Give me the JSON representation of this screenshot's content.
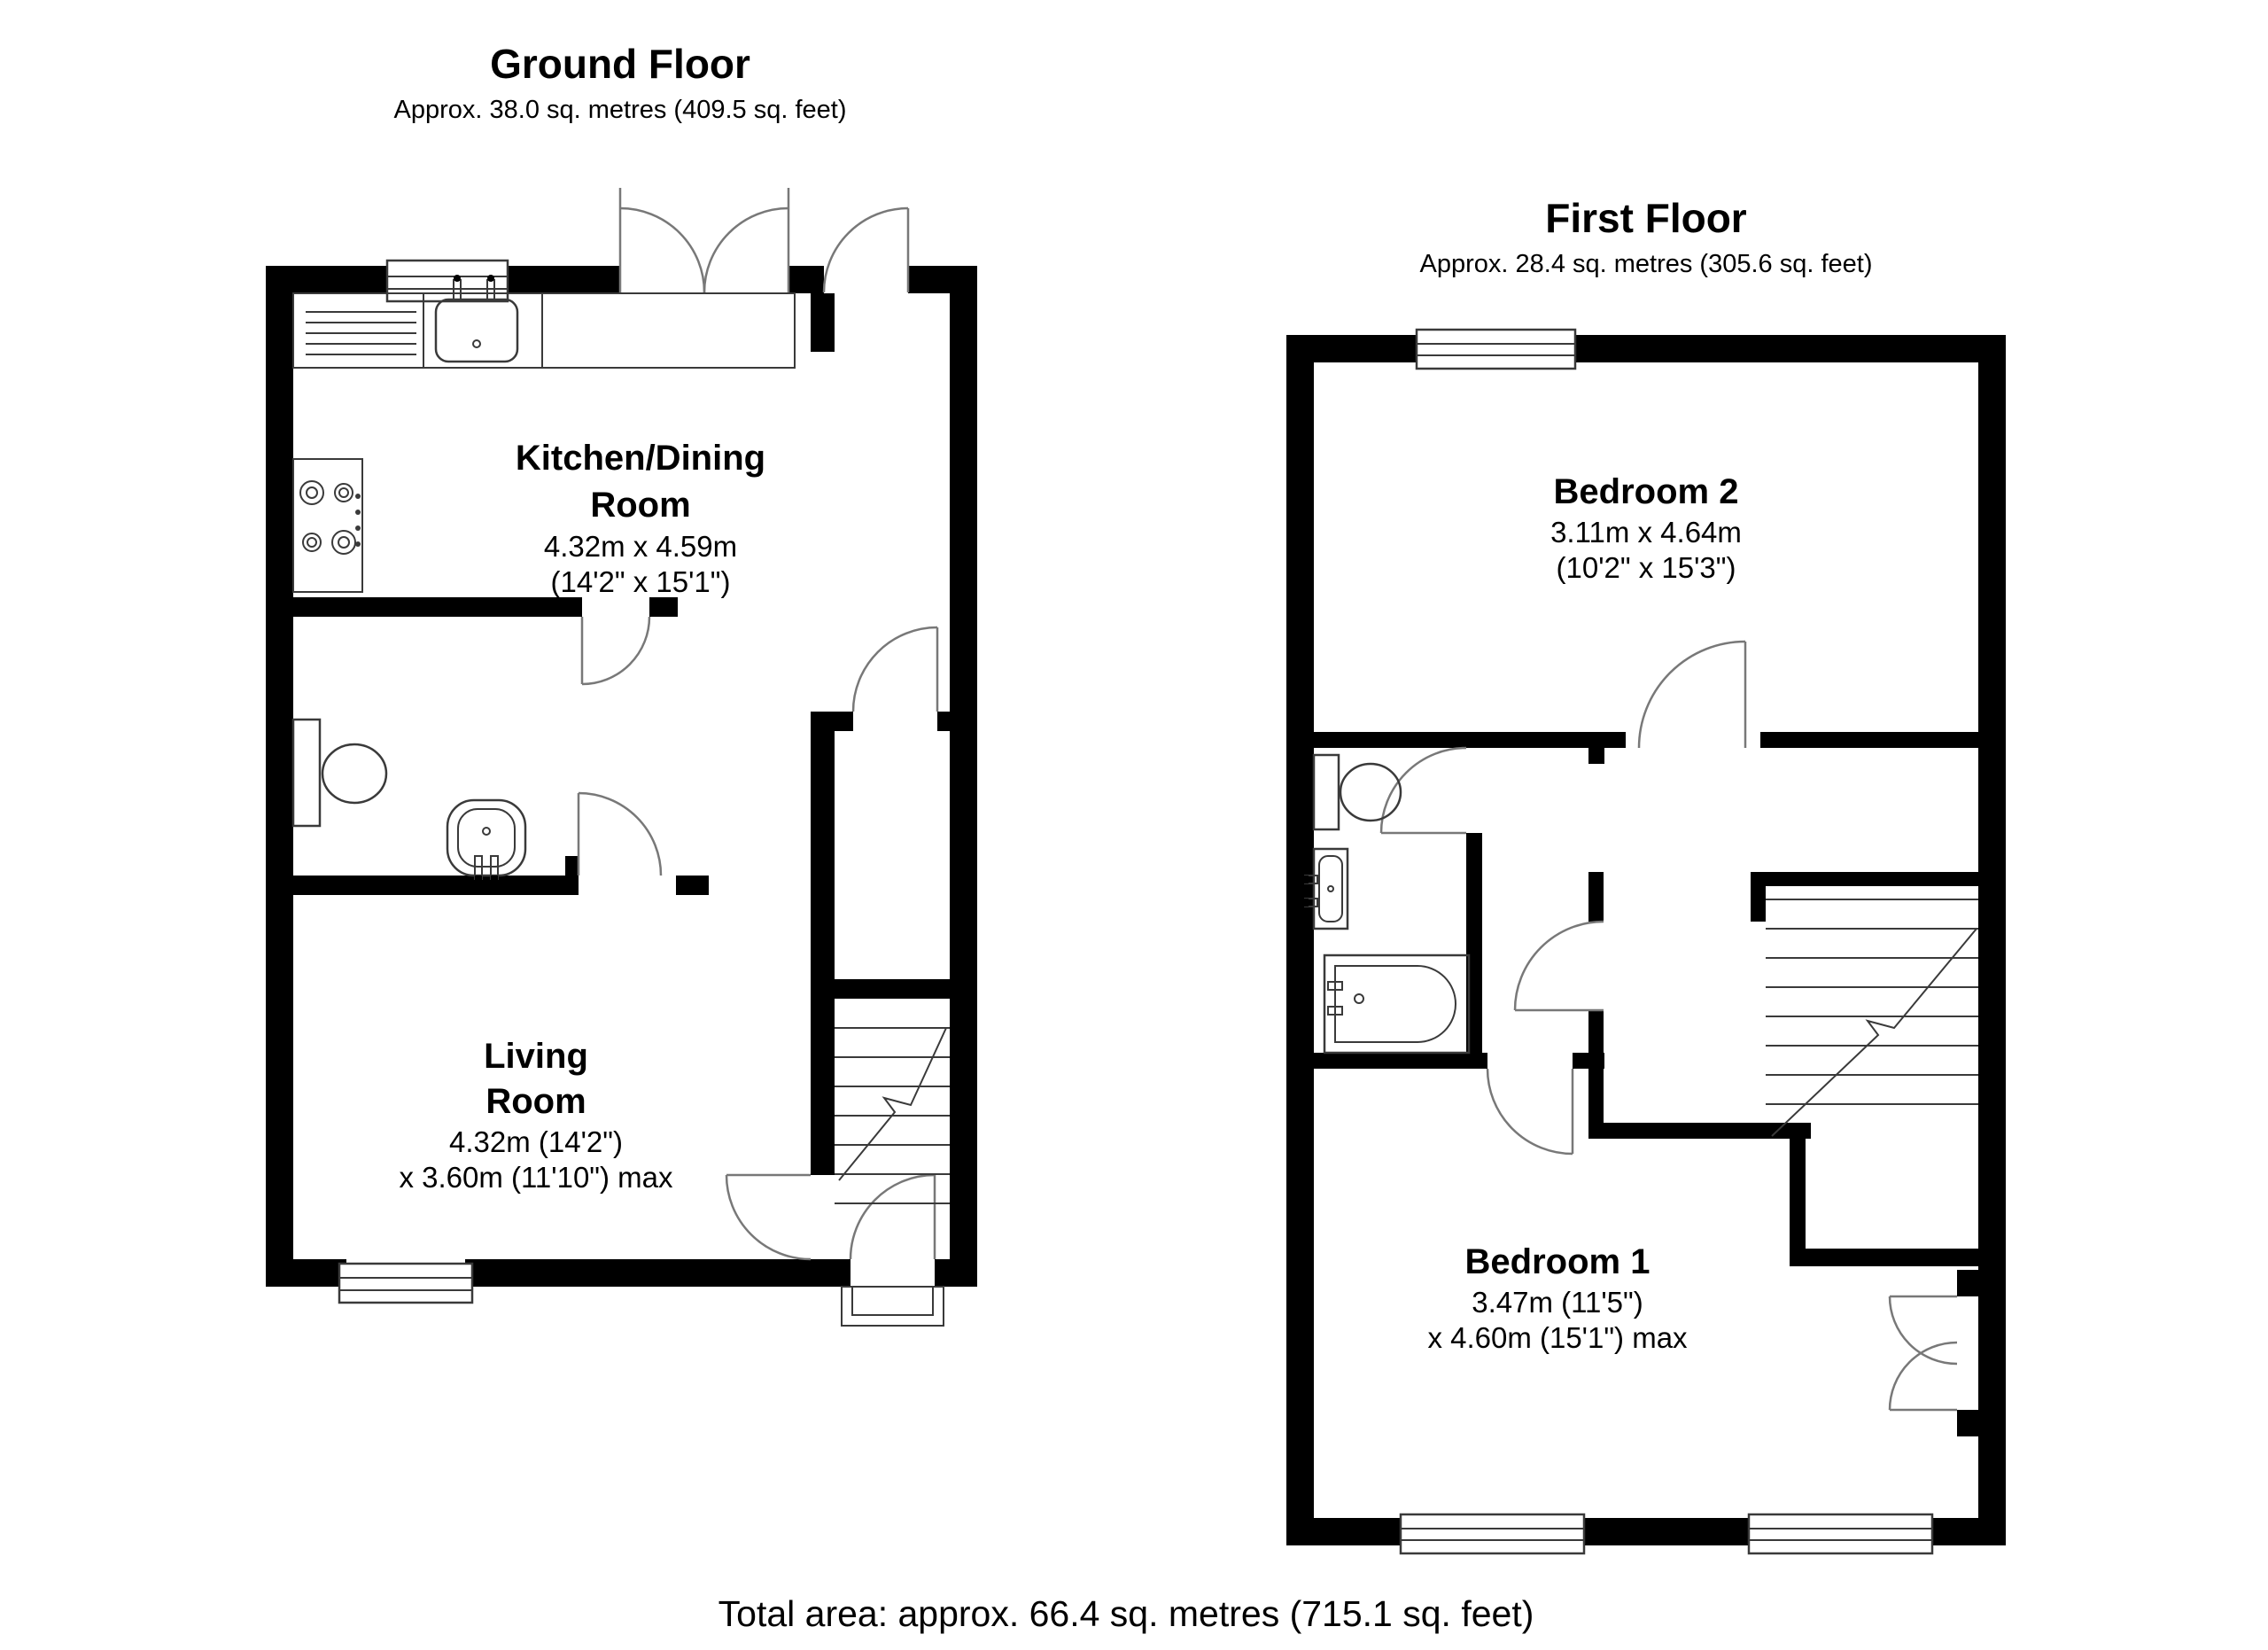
{
  "ground_floor": {
    "title": "Ground Floor",
    "subtitle": "Approx. 38.0 sq. metres (409.5 sq. feet)",
    "kitchen": {
      "name_line1": "Kitchen/Dining",
      "name_line2": "Room",
      "dims_line1": "4.32m x 4.59m",
      "dims_line2": "(14'2\" x 15'1\")"
    },
    "living": {
      "name_line1": "Living",
      "name_line2": "Room",
      "dims_line1": "4.32m (14'2\")",
      "dims_line2": "x 3.60m (11'10\") max"
    }
  },
  "first_floor": {
    "title": "First Floor",
    "subtitle": "Approx. 28.4 sq. metres (305.6 sq. feet)",
    "bedroom2": {
      "name": "Bedroom 2",
      "dims_line1": "3.11m x 4.64m",
      "dims_line2": "(10'2\" x 15'3\")"
    },
    "bedroom1": {
      "name": "Bedroom 1",
      "dims_line1": "3.47m (11'5\")",
      "dims_line2": "x 4.60m (15'1\") max"
    }
  },
  "footer": {
    "total_area": "Total area: approx. 66.4 sq. metres (715.1 sq. feet)"
  },
  "colors": {
    "wall": "#000000",
    "line": "#3a3a3a",
    "door_arc": "#787878",
    "background": "#ffffff"
  }
}
